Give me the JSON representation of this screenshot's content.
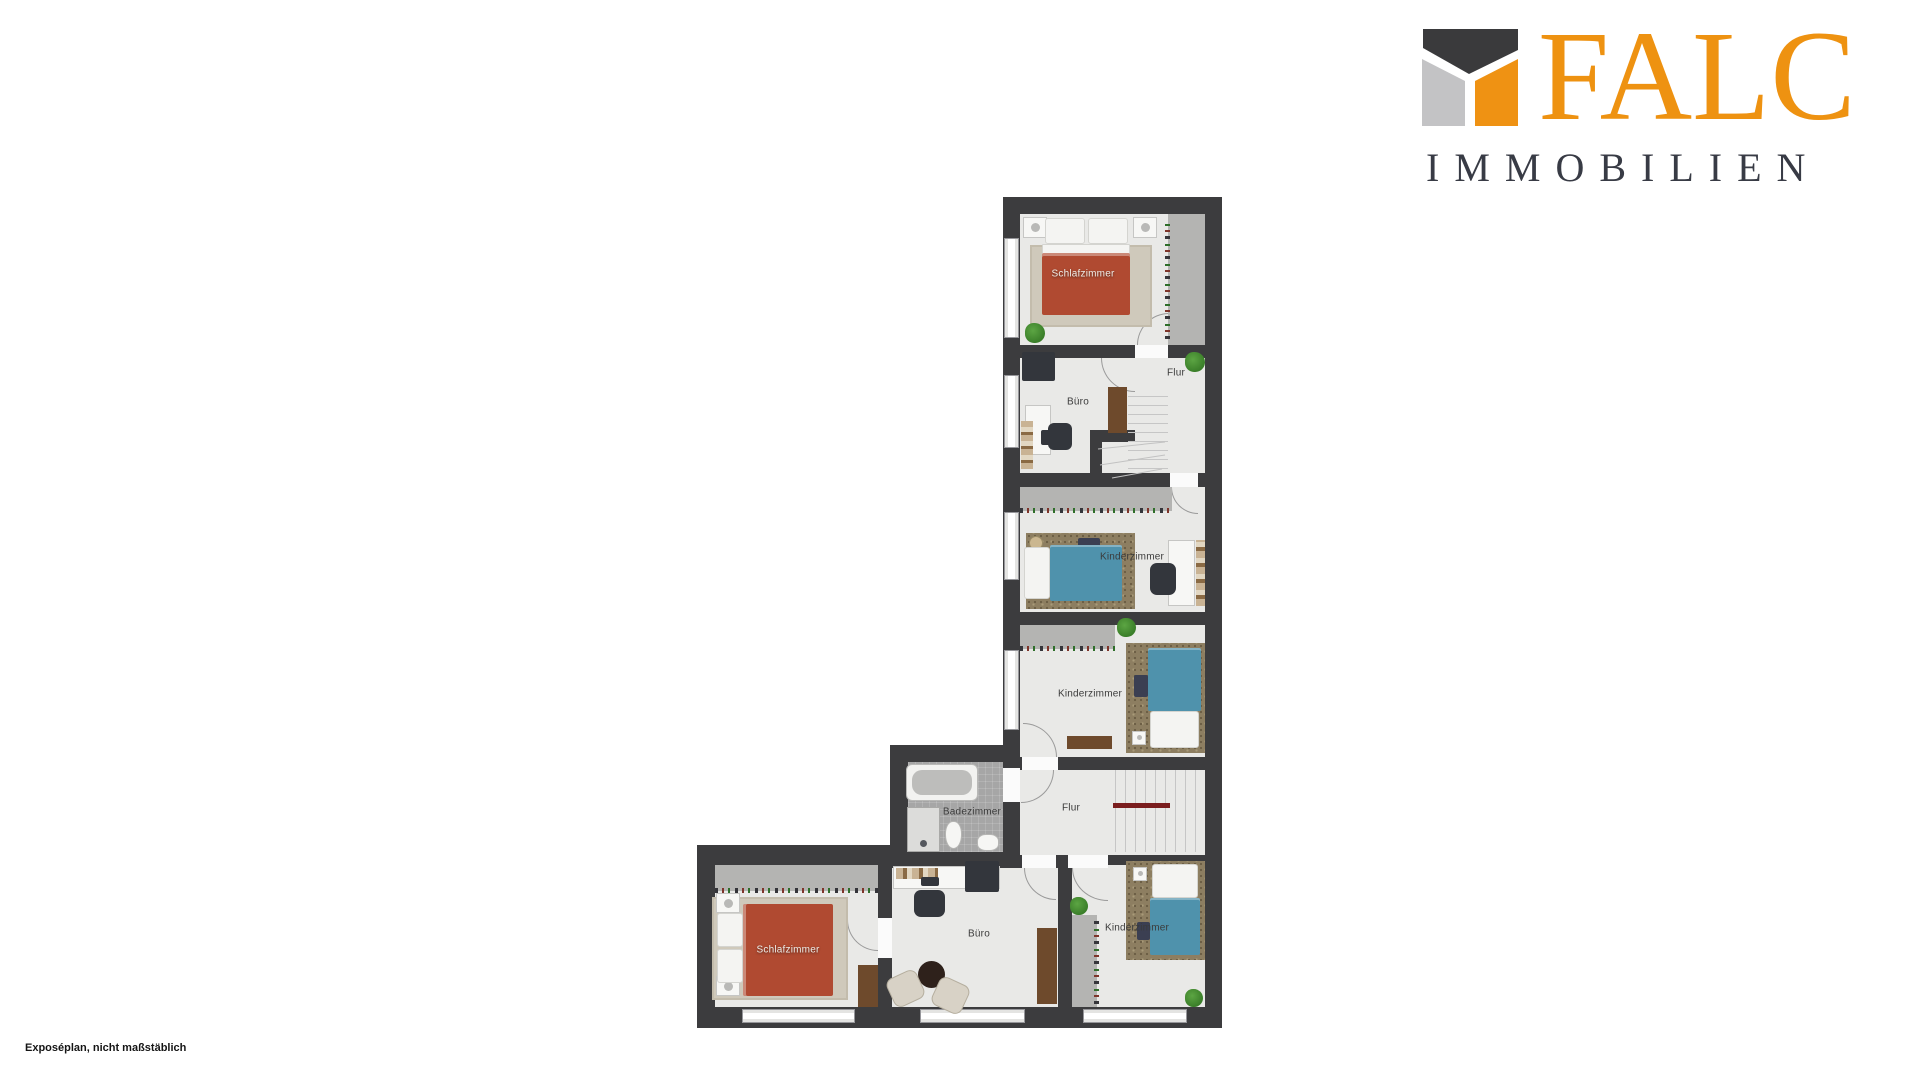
{
  "logo": {
    "brand": "FALC",
    "subtitle": "IMMOBILIEN",
    "icon": "falc-roof-icon",
    "colors": {
      "orange": "#EF9213",
      "text_dark": "#383B45",
      "icon_dark": "#3A3A3C",
      "icon_gray": "#C3C3C5"
    }
  },
  "plan": {
    "type": "floor-plan",
    "colors": {
      "wall": "#3C3C3E",
      "floor": "#E9E9E7",
      "wardrobe": "#B4B4B2",
      "bath_tile": "#A6A6A6",
      "bed_red": "#B04A31",
      "bed_teal": "#4F92AC",
      "rug_beige": "#CFC9BB",
      "rug_brown": "#8D7E61",
      "wood": "#6E4A2C",
      "handrail": "#7A1D1D",
      "plant": "#3F8F2D"
    },
    "rooms": [
      {
        "id": "schlafzimmer-top",
        "label": "Schlafzimmer"
      },
      {
        "id": "buero-top",
        "label": "Büro"
      },
      {
        "id": "flur-top",
        "label": "Flur"
      },
      {
        "id": "kinderzimmer-1",
        "label": "Kinderzimmer"
      },
      {
        "id": "kinderzimmer-2",
        "label": "Kinderzimmer"
      },
      {
        "id": "badezimmer",
        "label": "Badezimmer"
      },
      {
        "id": "flur-bottom",
        "label": "Flur"
      },
      {
        "id": "buero-bottom",
        "label": "Büro"
      },
      {
        "id": "schlafzimmer-bottom",
        "label": "Schlafzimmer"
      },
      {
        "id": "kinderzimmer-3",
        "label": "Kinderzimmer"
      }
    ]
  },
  "footer": {
    "disclaimer": "Exposéplan, nicht maßstäblich"
  }
}
